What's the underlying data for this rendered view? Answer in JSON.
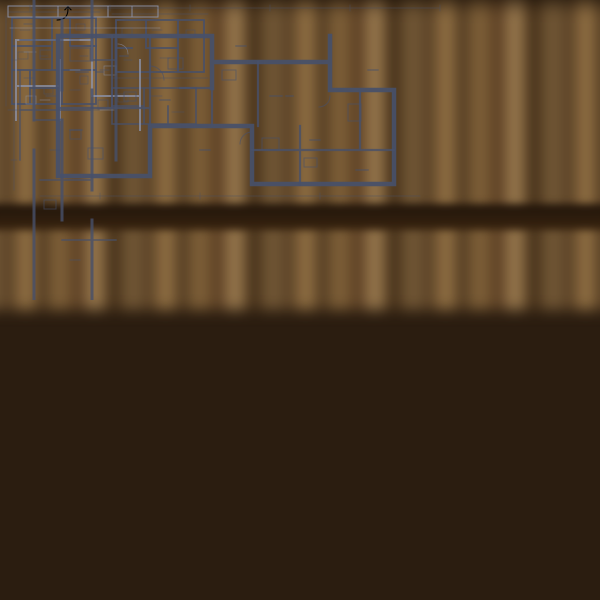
{
  "scene": {
    "setting": "architect-desk-video-lesson",
    "objects": [
      "bookshelf",
      "wooden-desk",
      "notebook-stack",
      "desk-pens",
      "laptop",
      "video-presenter",
      "whiteboard-floor-plans",
      "blueprint-sheets",
      "rolled-blueprint",
      "left-thumb",
      "right-hand-with-pen",
      "person-shoulder"
    ]
  },
  "colors": {
    "shelf_dark": "#2b1d10",
    "desk": "#7c5330",
    "laptop_body": "#b1aeaa",
    "bezel": "#141416",
    "screen_wall": "#d8ccbb",
    "whiteboard": "#f5f2ec",
    "plan_ink": "#47506a",
    "plan_ink_light": "#8c94ad",
    "paper": "#f2efe8",
    "shirt_blue": "#a7bed4",
    "skin": "#d5a081",
    "shoulder_gray": "#878c92",
    "progress_red": "#d43b35"
  },
  "laptop_screen": {
    "video_player": {
      "progress_percent": 22,
      "progress_width": "22%",
      "progress_color": "#d43b35",
      "controls": [
        {
          "name": "control-dot-white",
          "color": "#e8e8e8"
        },
        {
          "name": "control-dot-dark",
          "color": "#3c4147"
        },
        {
          "name": "control-dot-blue",
          "color": "#4a86c8"
        },
        {
          "name": "control-dot-gray",
          "color": "#606468"
        }
      ],
      "tray_icons": [
        {
          "name": "share-tray-icon",
          "color": "#2f3338"
        },
        {
          "name": "window-tray-icon",
          "color": "#4a90e2"
        },
        {
          "name": "camera-tray-icon",
          "color": "#43a85c"
        },
        {
          "name": "record-tray-icon",
          "color": "#d8423a"
        }
      ]
    }
  }
}
